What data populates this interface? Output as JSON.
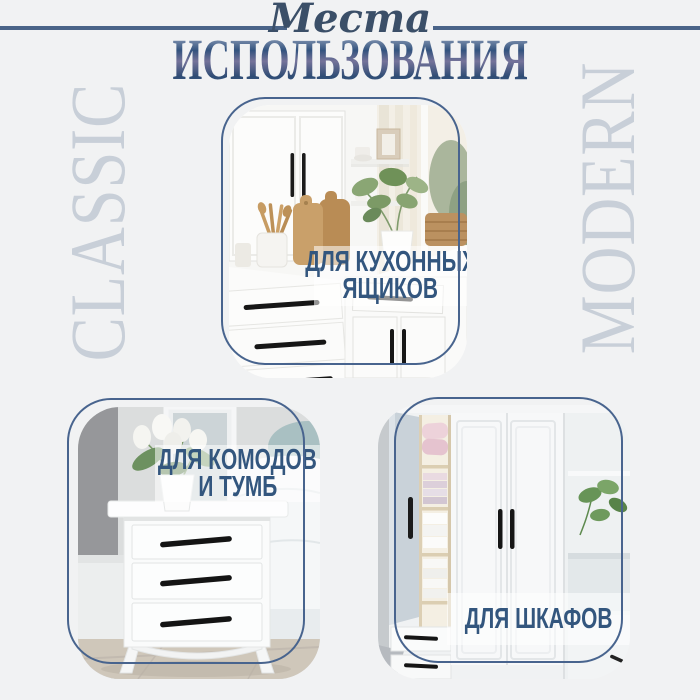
{
  "header": {
    "script_word": "Места",
    "title": "ИСПОЛЬЗОВАНИЯ"
  },
  "side_words": {
    "left": "CLASSIC",
    "right": "MODERN"
  },
  "cards": [
    {
      "name": "kitchen-drawers",
      "label_lines": [
        "ДЛЯ КУХОННЫХ",
        "ЯЩИКОВ"
      ]
    },
    {
      "name": "dressers-nightstands",
      "label_lines": [
        "ДЛЯ КОМОДОВ",
        "И ТУМБ"
      ]
    },
    {
      "name": "wardrobes",
      "label_lines": [
        "ДЛЯ ШКАФОВ"
      ]
    }
  ],
  "colors": {
    "background": "#f1f2f3",
    "accent_navy": "#3e5a80",
    "rule_blue": "#4a6488",
    "frame_blue": "#48648e",
    "label_navy": "#33567e",
    "muted_side_text": "#c8cfd8",
    "handle_black": "#1b1b1b"
  }
}
